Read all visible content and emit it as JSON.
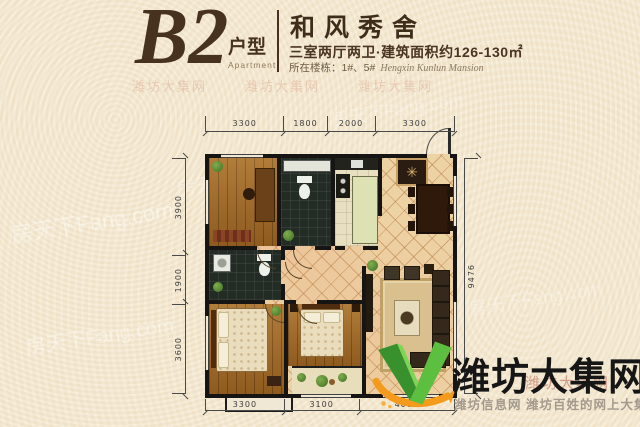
{
  "header": {
    "plan_code": "B2",
    "plan_type": "户型",
    "plan_type_en": "Apartment",
    "community_name": "和风秀舍",
    "subtitle": "三室两厅两卫·建筑面积约126-130㎡",
    "floor_label": "所在楼栋：1#、5#",
    "floor_label_en": "Hengxin Kunlun Mansion"
  },
  "dimensions": {
    "top": [
      "3300",
      "1800",
      "2000",
      "3300"
    ],
    "bottom": [
      "3300",
      "3100",
      "4000"
    ],
    "left": [
      "3900",
      "1900",
      "3600"
    ],
    "right": [
      "9476"
    ]
  },
  "logo": {
    "site_name": "潍坊大集网",
    "tagline": "潍坊信息网 潍坊百姓的网上大集",
    "icon": "v-check-icon",
    "green": "#4fae3a",
    "orange": "#f49a1c"
  },
  "watermark": {
    "fang": "房天下Fang.com",
    "site": "潍坊大集网"
  },
  "icons": {
    "medallion": "✳"
  },
  "colors": {
    "background": "#f4e7cd",
    "heading": "#46321f",
    "wall": "#171513",
    "wood_floor": "#a06a28",
    "tile_floor": "#edd2a4",
    "dark_tile": "#222b24"
  }
}
